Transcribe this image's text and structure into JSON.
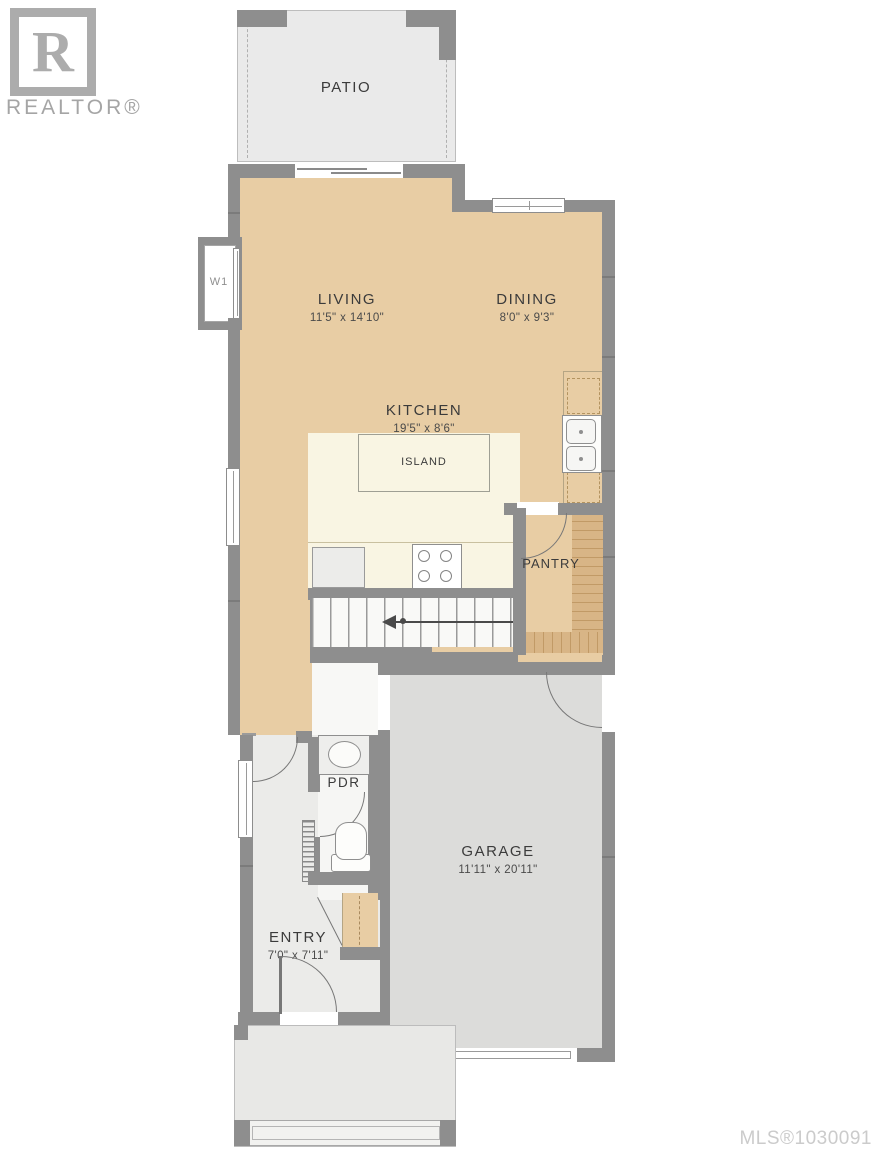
{
  "branding": {
    "logo_letter": "R",
    "wordmark": "REALTOR®",
    "mls_number": "MLS®1030091"
  },
  "rooms": {
    "patio": {
      "name": "PATIO"
    },
    "living": {
      "name": "LIVING",
      "dims": "11'5\" x 14'10\""
    },
    "dining": {
      "name": "DINING",
      "dims": "8'0\" x 9'3\""
    },
    "kitchen": {
      "name": "KITCHEN",
      "dims": "19'5\" x 8'6\""
    },
    "island": {
      "name": "ISLAND"
    },
    "pantry": {
      "name": "PANTRY"
    },
    "pdr": {
      "name": "PDR"
    },
    "garage": {
      "name": "GARAGE",
      "dims": "11'11\" x 20'11\""
    },
    "entry": {
      "name": "ENTRY",
      "dims": "7'0\" x 7'11\""
    }
  },
  "annotations": {
    "window_label": "W1"
  },
  "icons": {
    "stairs-direction-arrow": "left-pointing arrow with dot",
    "door-swing-arc": "quarter-circle arc",
    "window": "double-line white band in wall",
    "stove": "four burner circles",
    "double-sink": "two rounded basins",
    "toilet": "bowl with base",
    "oval-sink": "ellipse basin"
  },
  "colors": {
    "wall": "#8e8e8e",
    "floor_main_tan": "#e8cda4",
    "kitchen_cream": "#f9f5e3",
    "wood_shelf": "#d8b586",
    "garage_floor": "#dcdcda",
    "patio_floor": "#eaeaea",
    "hall_floor": "#ebebe9",
    "porch_floor": "#e8e8e6",
    "label_text": "#3b3b3b",
    "mls_text": "#cbcbcb",
    "logo_gray": "#acacac"
  }
}
